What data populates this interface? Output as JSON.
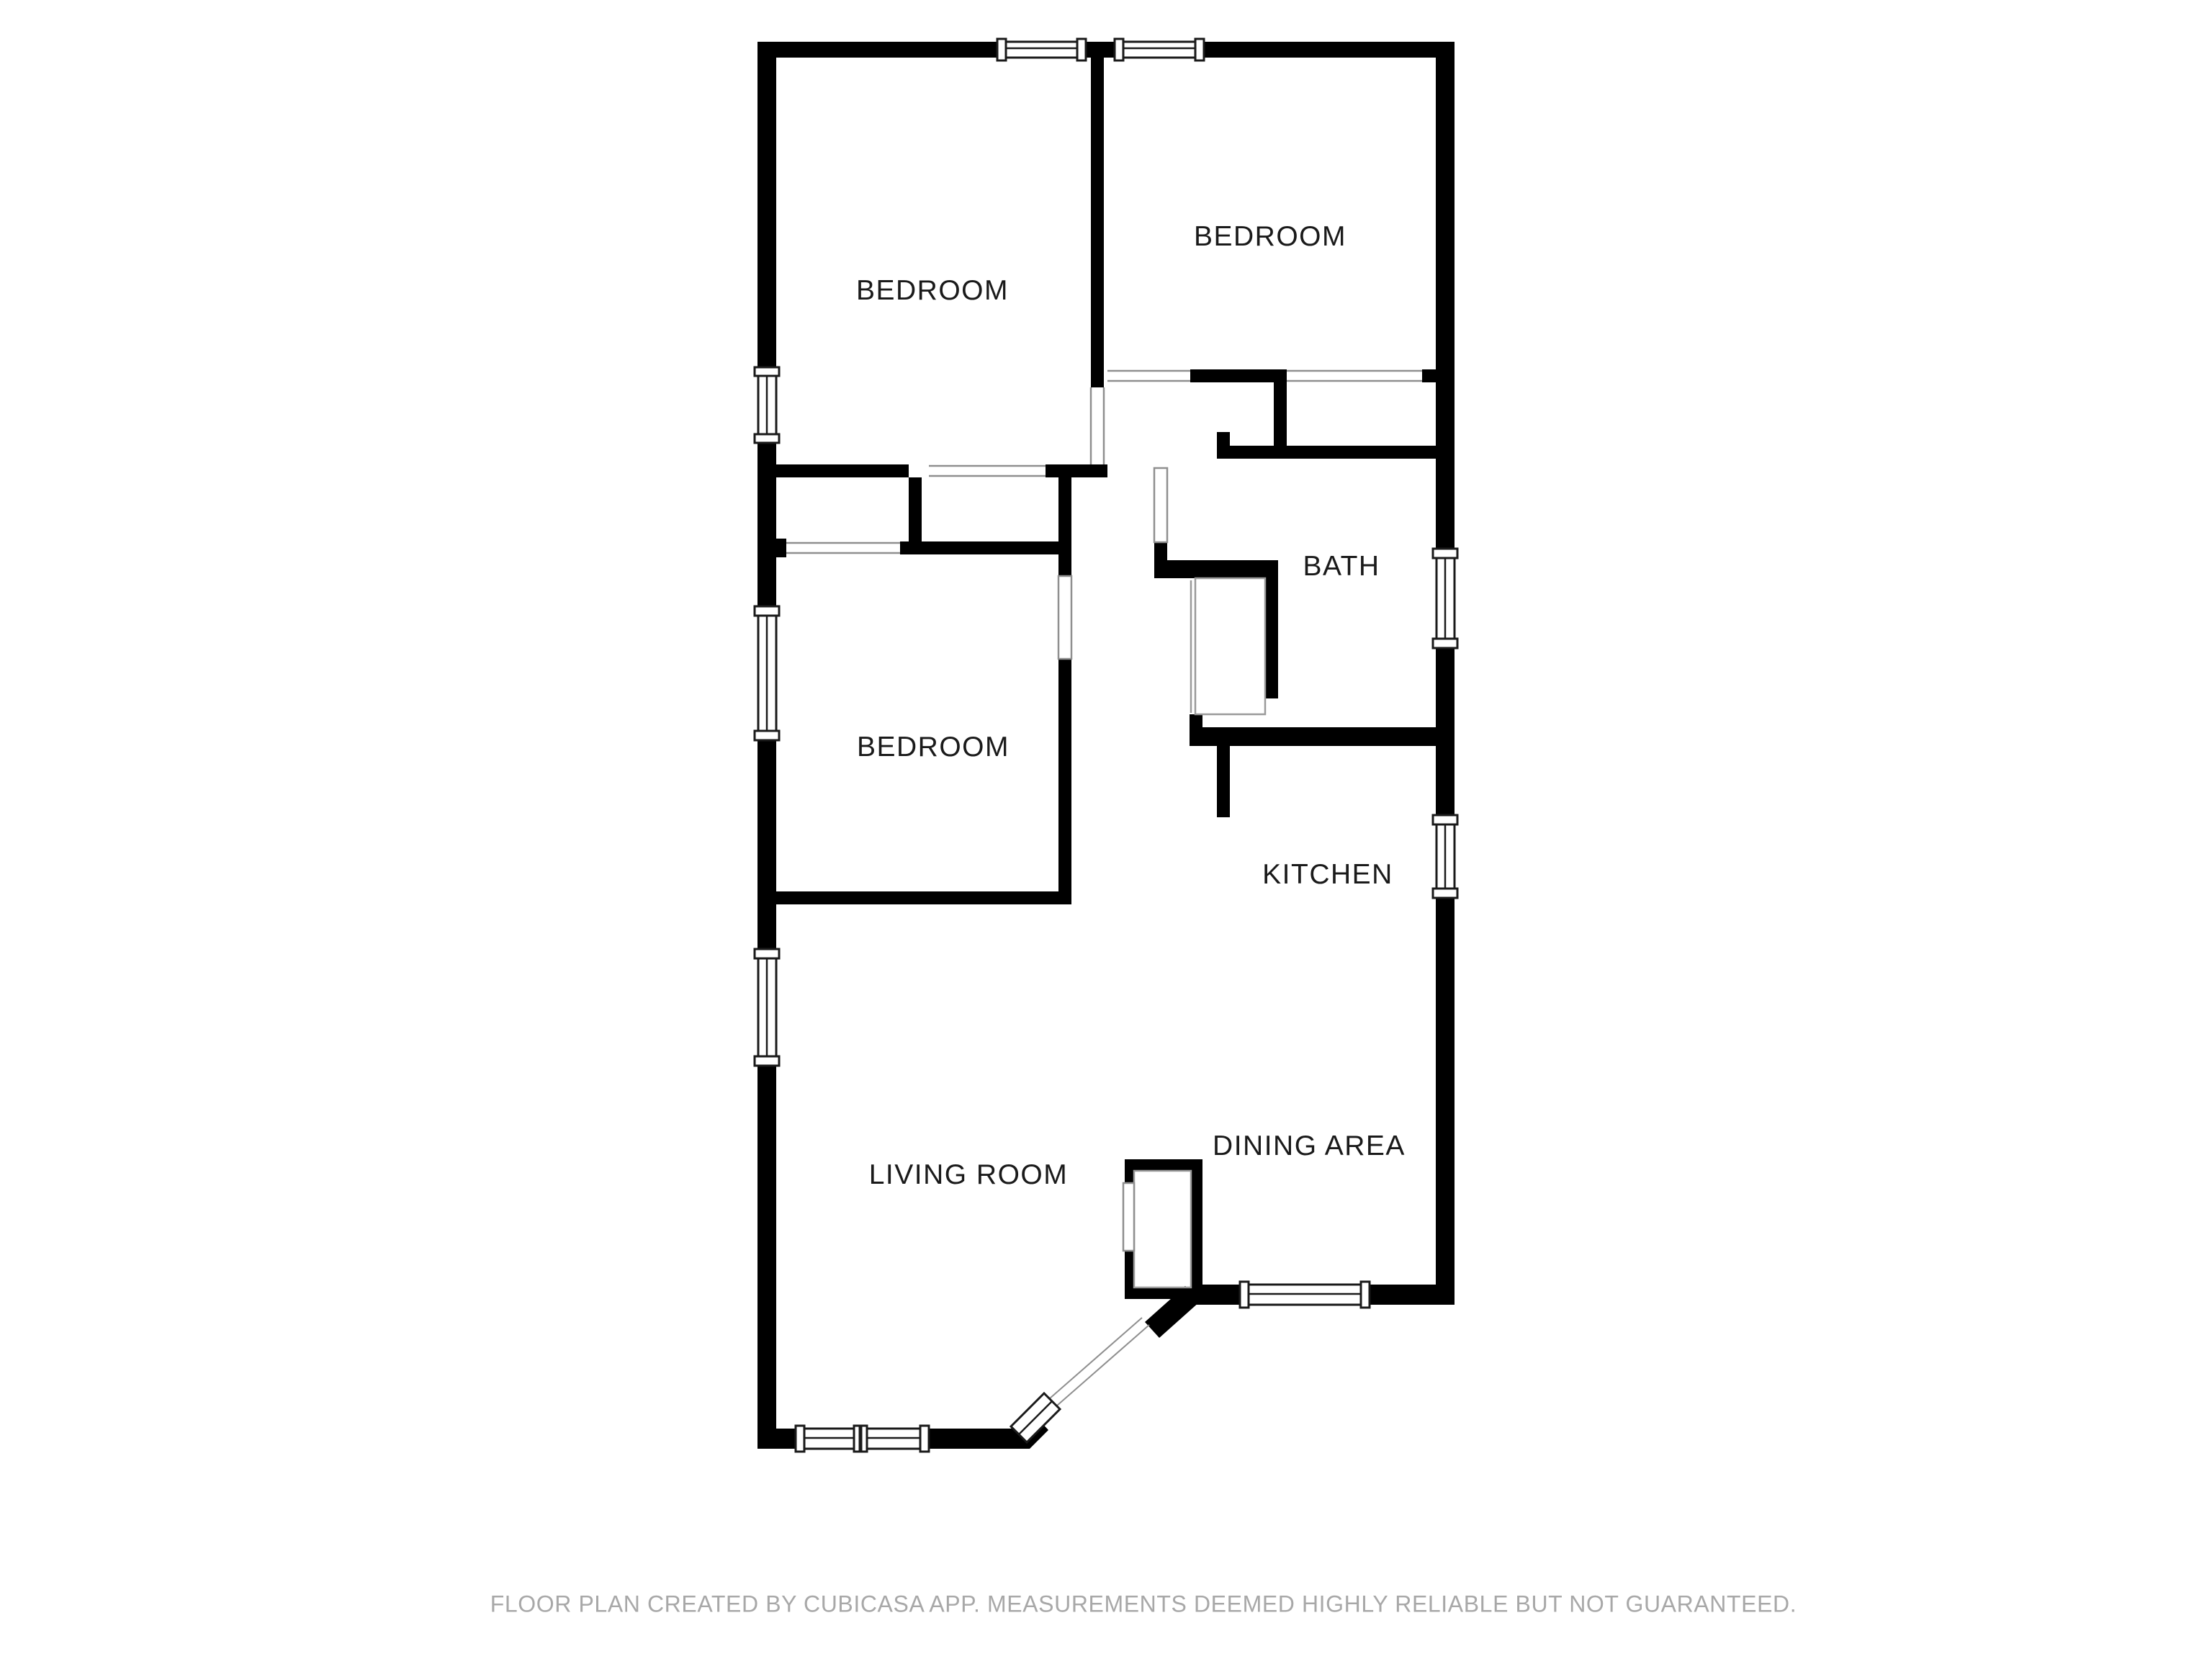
{
  "plan": {
    "title": "Floor plan",
    "rooms": [
      {
        "id": "bedroom-top-left",
        "label": "BEDROOM"
      },
      {
        "id": "bedroom-top-right",
        "label": "BEDROOM"
      },
      {
        "id": "bath",
        "label": "BATH"
      },
      {
        "id": "bedroom-middle",
        "label": "BEDROOM"
      },
      {
        "id": "kitchen",
        "label": "KITCHEN"
      },
      {
        "id": "living-room",
        "label": "LIVING ROOM"
      },
      {
        "id": "dining-area",
        "label": "DINING AREA"
      }
    ],
    "footer": "FLOOR PLAN CREATED BY CUBICASA APP. MEASUREMENTS DEEMED HIGHLY RELIABLE BUT NOT GUARANTEED.",
    "colors": {
      "background": "#ffffff",
      "wall": "#000000",
      "label_text": "#1a1a1a",
      "footer_text": "#a8a8a8",
      "window_frame": "#1a1a1a",
      "opening_line": "#8f8f8f"
    }
  }
}
